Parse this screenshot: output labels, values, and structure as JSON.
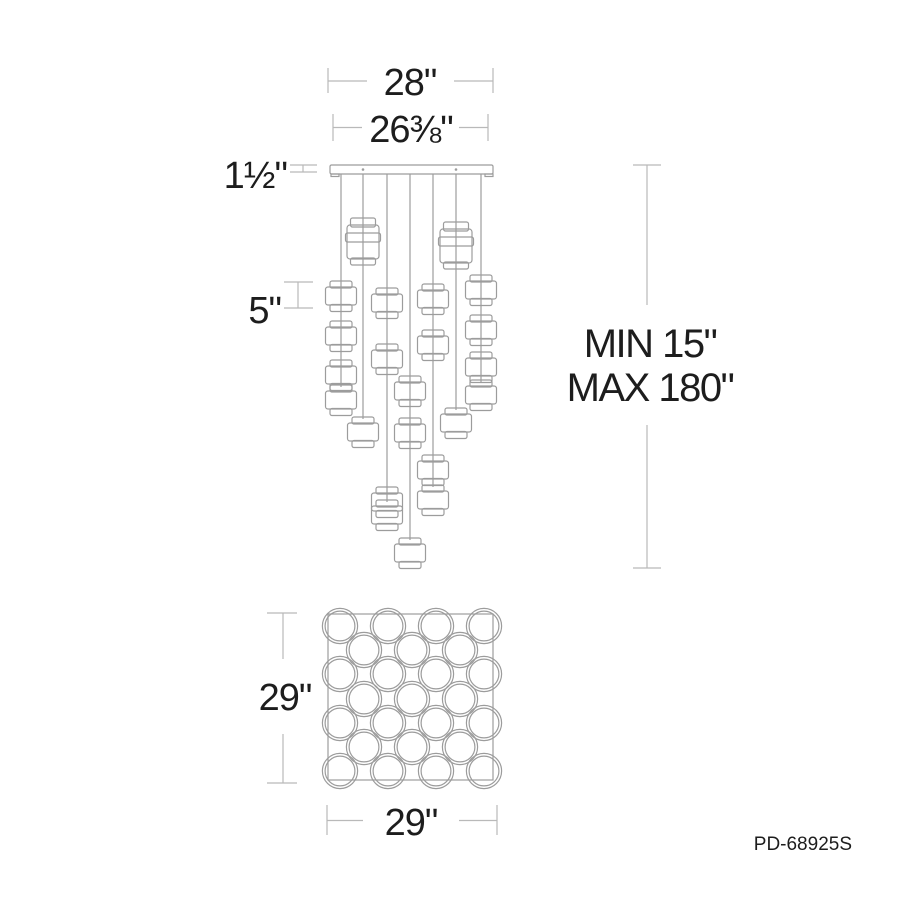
{
  "product_code": "PD-68925S",
  "colors": {
    "background": "#ffffff",
    "fixture_line": "#9c9c9c",
    "dimension_line": "#b9b9b9",
    "text": "#1d1d1d"
  },
  "dimensions": {
    "canopy_width": "28\"",
    "wire_span": "26⅜\"",
    "canopy_height": "1½\"",
    "pendant_height": "5\"",
    "suspension_min": "MIN 15\"",
    "suspension_max": "MAX 180\"",
    "plan_depth": "29\"",
    "plan_width": "29\""
  },
  "side_view": {
    "canopy": {
      "x": 330,
      "y": 165,
      "w": 163,
      "h": 9
    },
    "canopy_tabs": [
      {
        "x": 331,
        "y": 174,
        "w": 8,
        "h": 2.5
      },
      {
        "x": 485,
        "y": 174,
        "w": 8,
        "h": 2.5
      }
    ],
    "screws": [
      {
        "cx": 363,
        "cy": 169.5
      },
      {
        "cx": 456,
        "cy": 169.5
      }
    ],
    "wires": [
      {
        "x": 341,
        "to": 387
      },
      {
        "x": 363,
        "to": 419
      },
      {
        "x": 387,
        "to": 502
      },
      {
        "x": 410,
        "to": 540
      },
      {
        "x": 433,
        "to": 487
      },
      {
        "x": 456,
        "to": 410
      },
      {
        "x": 481,
        "to": 382
      }
    ],
    "pendants": [
      {
        "cx": 341,
        "top": 281,
        "type": "single"
      },
      {
        "cx": 341,
        "top": 321,
        "type": "single"
      },
      {
        "cx": 341,
        "top": 360,
        "type": "single"
      },
      {
        "cx": 341,
        "top": 385,
        "type": "single"
      },
      {
        "cx": 363,
        "top": 218,
        "type": "double"
      },
      {
        "cx": 363,
        "top": 417,
        "type": "single"
      },
      {
        "cx": 387,
        "top": 288,
        "type": "single"
      },
      {
        "cx": 387,
        "top": 344,
        "type": "single"
      },
      {
        "cx": 387,
        "top": 487,
        "type": "single"
      },
      {
        "cx": 387,
        "top": 500,
        "type": "single"
      },
      {
        "cx": 410,
        "top": 376,
        "type": "single"
      },
      {
        "cx": 410,
        "top": 418,
        "type": "single"
      },
      {
        "cx": 410,
        "top": 538,
        "type": "single"
      },
      {
        "cx": 433,
        "top": 284,
        "type": "single"
      },
      {
        "cx": 433,
        "top": 330,
        "type": "single"
      },
      {
        "cx": 433,
        "top": 455,
        "type": "single"
      },
      {
        "cx": 433,
        "top": 485,
        "type": "single"
      },
      {
        "cx": 456,
        "top": 222,
        "type": "double"
      },
      {
        "cx": 456,
        "top": 408,
        "type": "single"
      },
      {
        "cx": 481,
        "top": 275,
        "type": "single"
      },
      {
        "cx": 481,
        "top": 315,
        "type": "single"
      },
      {
        "cx": 481,
        "top": 352,
        "type": "single"
      },
      {
        "cx": 481,
        "top": 380,
        "type": "single"
      }
    ]
  },
  "plan_view": {
    "square": {
      "x": 328,
      "y": 614,
      "w": 165,
      "h": 166
    },
    "r_outer": 17.6,
    "r_inner": 14.9,
    "rows": [
      {
        "y": 626,
        "xs": [
          340,
          388,
          436,
          484
        ]
      },
      {
        "y": 650,
        "xs": [
          364,
          412,
          460
        ]
      },
      {
        "y": 674,
        "xs": [
          340,
          388,
          436,
          484
        ]
      },
      {
        "y": 699,
        "xs": [
          364,
          412,
          460
        ]
      },
      {
        "y": 723,
        "xs": [
          340,
          388,
          436,
          484
        ]
      },
      {
        "y": 747,
        "xs": [
          364,
          412,
          460
        ]
      },
      {
        "y": 771,
        "xs": [
          340,
          388,
          436,
          484
        ]
      }
    ]
  }
}
